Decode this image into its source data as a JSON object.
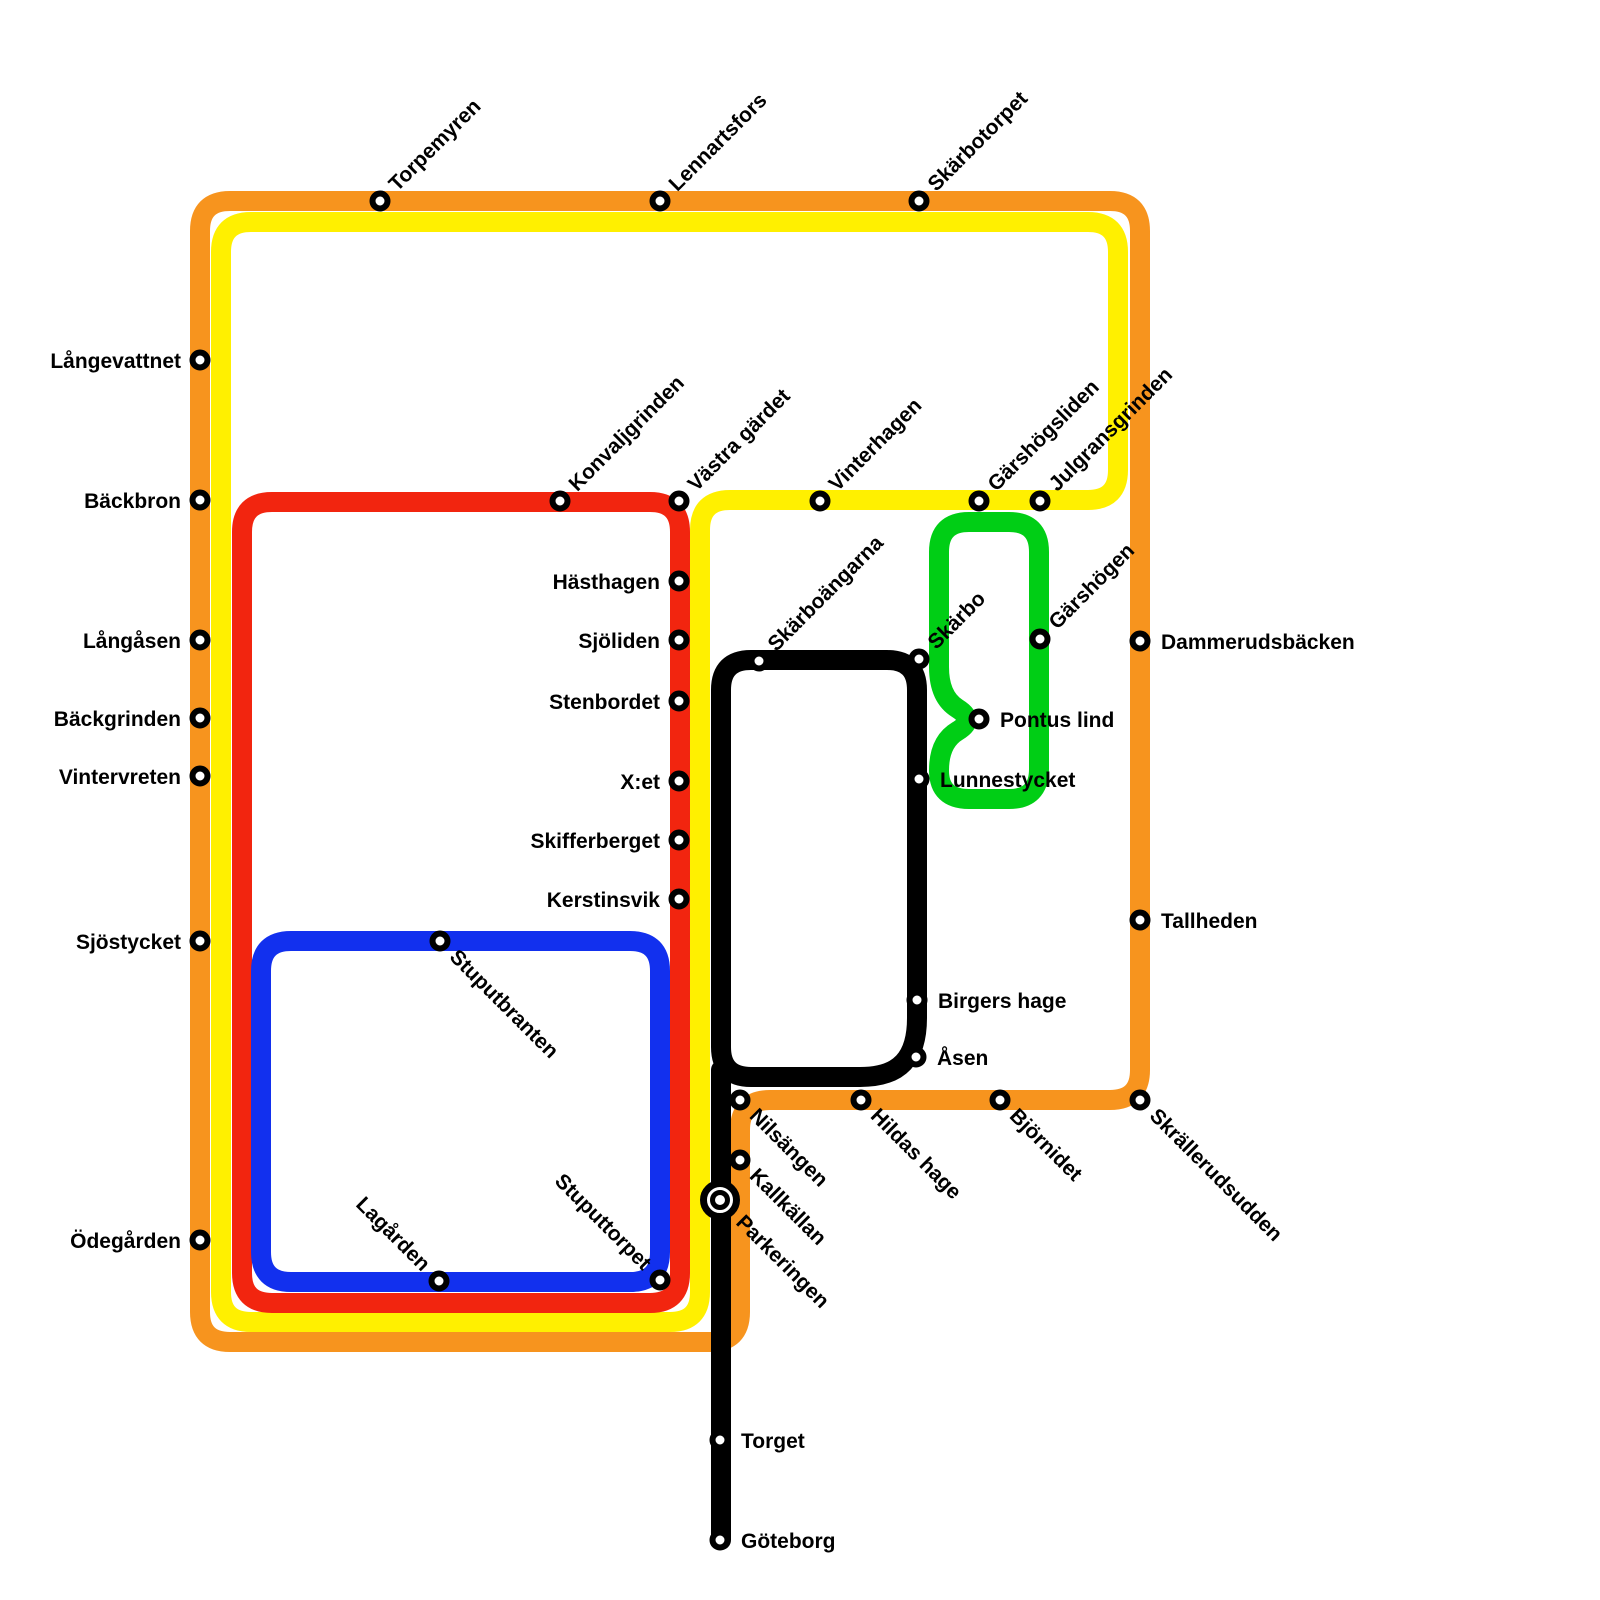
{
  "map": {
    "title": "Transit network map",
    "width": 1600,
    "height": 1600,
    "background": "#ffffff",
    "label_font_size": 21,
    "line_width": 20,
    "corner_radius": 30,
    "station_style": {
      "radius": 7.5,
      "ring_width": 6,
      "ring_color": "#000000",
      "fill": "#ffffff"
    },
    "interchange_style": {
      "outer_radius": 16.5,
      "outer_ring_width": 7,
      "inner_radius": 7.5,
      "inner_ring_width": 5
    }
  },
  "lines": [
    {
      "id": "orange-line",
      "color": "#F7941E",
      "width": 20,
      "closed": true,
      "points": [
        [
          200,
          201
        ],
        [
          1140,
          201
        ],
        [
          1140,
          1100
        ],
        [
          740,
          1100
        ],
        [
          740,
          1342
        ],
        [
          200,
          1342
        ]
      ]
    },
    {
      "id": "yellow-line",
      "color": "#FFF000",
      "width": 20,
      "closed": true,
      "points": [
        [
          221,
          222
        ],
        [
          1118,
          222
        ],
        [
          1118,
          500
        ],
        [
          700,
          500
        ],
        [
          700,
          1322
        ],
        [
          221,
          1322
        ]
      ]
    },
    {
      "id": "red-line",
      "color": "#F2250F",
      "width": 20,
      "closed": true,
      "points": [
        [
          242,
          502
        ],
        [
          680,
          502
        ],
        [
          680,
          1303
        ],
        [
          242,
          1303
        ]
      ]
    },
    {
      "id": "blue-line",
      "color": "#1230EE",
      "width": 20,
      "closed": true,
      "points": [
        [
          261,
          941
        ],
        [
          660,
          941
        ],
        [
          660,
          1282
        ],
        [
          261,
          1282
        ]
      ]
    },
    {
      "id": "green-line",
      "color": "#00CE15",
      "width": 20,
      "closed": true,
      "points": [
        [
          939,
          522
        ],
        [
          1039,
          522
        ],
        [
          1039,
          799
        ],
        [
          939,
          799
        ],
        [
          939,
          742
        ],
        [
          976,
          720
        ],
        [
          939,
          697
        ]
      ]
    },
    {
      "id": "black-loop",
      "color": "#000000",
      "width": 20,
      "closed": true,
      "points": [
        [
          721,
          660
        ],
        [
          917,
          660
        ],
        [
          917,
          1048
        ],
        [
          890,
          1077
        ],
        [
          721,
          1077
        ]
      ]
    },
    {
      "id": "black-stem",
      "color": "#000000",
      "width": 20,
      "closed": false,
      "points": [
        [
          721,
          1070
        ],
        [
          721,
          1540
        ]
      ]
    }
  ],
  "stations": [
    {
      "id": "langevattnet",
      "name": "Långevattnet",
      "x": 200,
      "y": 360,
      "label": "left"
    },
    {
      "id": "backbron",
      "name": "Bäckbron",
      "x": 200,
      "y": 500,
      "label": "left"
    },
    {
      "id": "langasen",
      "name": "Långåsen",
      "x": 200,
      "y": 640,
      "label": "left"
    },
    {
      "id": "backgrinden",
      "name": "Bäckgrinden",
      "x": 200,
      "y": 718,
      "label": "left"
    },
    {
      "id": "vintervreten",
      "name": "Vintervreten",
      "x": 200,
      "y": 776,
      "label": "left"
    },
    {
      "id": "sjostycket",
      "name": "Sjöstycket",
      "x": 200,
      "y": 941,
      "label": "left"
    },
    {
      "id": "odegarden",
      "name": "Ödegården",
      "x": 200,
      "y": 1240,
      "label": "left"
    },
    {
      "id": "torpemyren",
      "name": "Torpemyren",
      "x": 380,
      "y": 201,
      "label": "diag-up"
    },
    {
      "id": "lennartsfors",
      "name": "Lennartsfors",
      "x": 660,
      "y": 201,
      "label": "diag-up"
    },
    {
      "id": "skarbotorpet",
      "name": "Skärbotorpet",
      "x": 919,
      "y": 201,
      "label": "diag-up"
    },
    {
      "id": "konvaljgrinden",
      "name": "Konvaljgrinden",
      "x": 560,
      "y": 501,
      "label": "diag-up"
    },
    {
      "id": "vastra-gardet",
      "name": "Västra gärdet",
      "x": 679,
      "y": 501,
      "label": "diag-up"
    },
    {
      "id": "vinterhagen",
      "name": "Vinterhagen",
      "x": 820,
      "y": 501,
      "label": "diag-up"
    },
    {
      "id": "garshogsliden",
      "name": "Gärshögsliden",
      "x": 979,
      "y": 501,
      "label": "diag-up"
    },
    {
      "id": "julgransgrinden",
      "name": "Julgransgrinden",
      "x": 1040,
      "y": 501,
      "label": "diag-up"
    },
    {
      "id": "hasthagen",
      "name": "Hästhagen",
      "x": 679,
      "y": 581,
      "label": "left"
    },
    {
      "id": "sjoliden",
      "name": "Sjöliden",
      "x": 679,
      "y": 640,
      "label": "left"
    },
    {
      "id": "stenbordet",
      "name": "Stenbordet",
      "x": 679,
      "y": 701,
      "label": "left"
    },
    {
      "id": "x-et",
      "name": "X:et",
      "x": 679,
      "y": 781,
      "label": "left"
    },
    {
      "id": "skifferberget",
      "name": "Skifferberget",
      "x": 679,
      "y": 840,
      "label": "left"
    },
    {
      "id": "kerstinsvik",
      "name": "Kerstinsvik",
      "x": 679,
      "y": 899,
      "label": "left"
    },
    {
      "id": "skarboangarna",
      "name": "Skärboängarna",
      "x": 759,
      "y": 661,
      "label": "diag-up"
    },
    {
      "id": "skarbo",
      "name": "Skärbo",
      "x": 919,
      "y": 659,
      "label": "diag-up"
    },
    {
      "id": "garshogen",
      "name": "Gärshögen",
      "x": 1040,
      "y": 639,
      "label": "diag-up"
    },
    {
      "id": "pontus-lind",
      "name": "Pontus lind",
      "x": 979,
      "y": 719,
      "label": "right"
    },
    {
      "id": "lunnestycket",
      "name": "Lunnestycket",
      "x": 919,
      "y": 779,
      "label": "right"
    },
    {
      "id": "dammerudsbacken",
      "name": "Dammerudsbäcken",
      "x": 1140,
      "y": 641,
      "label": "right"
    },
    {
      "id": "tallheden",
      "name": "Tallheden",
      "x": 1140,
      "y": 920,
      "label": "right"
    },
    {
      "id": "birgers-hage",
      "name": "Birgers hage",
      "x": 917,
      "y": 1000,
      "label": "right"
    },
    {
      "id": "asen",
      "name": "Åsen",
      "x": 916,
      "y": 1057,
      "label": "right"
    },
    {
      "id": "hildas-hage",
      "name": "Hildas hage",
      "x": 861,
      "y": 1100,
      "label": "diag-down"
    },
    {
      "id": "bjornidet",
      "name": "Björnidet",
      "x": 1000,
      "y": 1100,
      "label": "diag-down"
    },
    {
      "id": "skrallerudsudden",
      "name": "Skrällerudsudden",
      "x": 1140,
      "y": 1100,
      "label": "diag-down"
    },
    {
      "id": "nilsangen",
      "name": "Nilsängen",
      "x": 740,
      "y": 1100,
      "label": "diag-down"
    },
    {
      "id": "kallkallan",
      "name": "Kallkällan",
      "x": 740,
      "y": 1160,
      "label": "diag-down"
    },
    {
      "id": "parkeringen",
      "name": "Parkeringen",
      "x": 720,
      "y": 1200,
      "label": "diag-down",
      "interchange": true
    },
    {
      "id": "stuputbranten",
      "name": "Stuputbranten",
      "x": 440,
      "y": 941,
      "label": "diag-down"
    },
    {
      "id": "lagarden",
      "name": "Lagården",
      "x": 439,
      "y": 1281,
      "label": "diag-down-end"
    },
    {
      "id": "stuputtorpet",
      "name": "Stuputtorpet",
      "x": 660,
      "y": 1280,
      "label": "diag-down-end"
    },
    {
      "id": "torget",
      "name": "Torget",
      "x": 720,
      "y": 1440,
      "label": "right"
    },
    {
      "id": "goteborg",
      "name": "Göteborg",
      "x": 720,
      "y": 1540,
      "label": "right"
    }
  ]
}
